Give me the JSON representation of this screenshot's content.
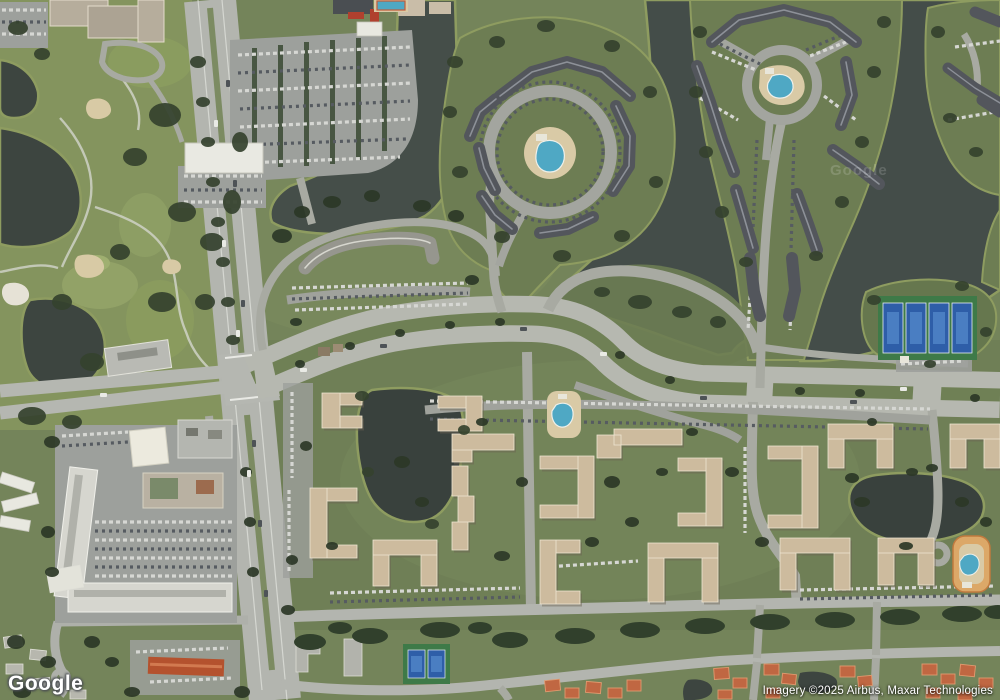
{
  "meta": {
    "view_type": "satellite",
    "width_px": 1000,
    "height_px": 700
  },
  "branding": {
    "logo_text": "Google",
    "tile_watermark": "Google"
  },
  "attribution": {
    "text": "Imagery ©2025 Airbus, Maxar Technologies"
  },
  "palette": {
    "grass": "#76865a",
    "golf-grass": "#84945e",
    "complex-grass": "#72825a",
    "water": "#47504b",
    "water-dark": "#3f4944",
    "shore-rim": "#8e9c60",
    "tree": "#35422e",
    "tree-dark": "#2c3827",
    "road": "#b5b7b1",
    "road-minor": "#a8aaa2",
    "parking": "#9da09c",
    "dark-roof": "#53565c",
    "dark-roof-ridge": "#8d9198",
    "tan-roof": "#cdbb9e",
    "tan-roof-ridge": "#efe6d2",
    "white-roof": "#e6e6df",
    "red-roof": "#b4522e",
    "orange-house-roof": "#c06742",
    "pool-blue": "#4fa8c4",
    "pool-deck": "#d9caa6",
    "tennis-court-blue": "#2e5ea8",
    "tennis-pad-green": "#3e7a48",
    "sand": "#d8caa5"
  }
}
